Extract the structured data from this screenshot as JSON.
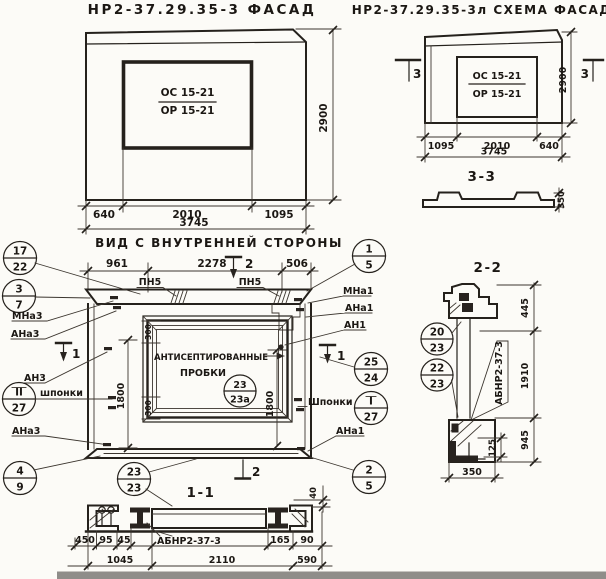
{
  "facade": {
    "title": "НР2-37.29.35-3 ФАСАД",
    "window_mark": {
      "top": "ОС 15-21",
      "bottom": "ОР 15-21"
    },
    "dims": {
      "left": "640",
      "mid": "2010",
      "right": "1095",
      "total": "3745",
      "height": "2900"
    }
  },
  "scheme": {
    "title": "НР2-37.29.35-3л СХЕМА ФАСАДА",
    "window_mark": {
      "top": "ОС 15-21",
      "bottom": "ОР 15-21"
    },
    "marker_left": "3",
    "marker_right": "3",
    "section_label": "3-3",
    "dims": {
      "left": "1095",
      "mid": "2010",
      "right": "640",
      "total": "3745",
      "height": "2900",
      "profile_thickness": "350"
    }
  },
  "inner_view": {
    "title": "ВИД С ВНУТРЕННЕЙ СТОРОНЫ",
    "dims": {
      "left": "961",
      "mid": "2278",
      "right": "506",
      "height_left": "1800",
      "height_right": "1800",
      "corner_top": "300",
      "corner_bottom": "300"
    },
    "markers": {
      "top": "2",
      "left": "1",
      "right": "1"
    },
    "labels": {
      "pn5_left": "ПН5",
      "pn5_right": "ПН5",
      "mna3": "МНа3",
      "ana3_top": "АНа3",
      "an3": "АН3",
      "shponki_left": "шпонки",
      "ana3_bottom": "АНа3",
      "mna1": "МНа1",
      "ana1_top": "АНа1",
      "an1": "АН1",
      "shponki_right": "Шпонки",
      "ana1_bottom": "АНа1",
      "plugs_line1": "АНТИСЕПТИРОВАННЫЕ",
      "plugs_line2": "ПРОБКИ"
    },
    "callouts": {
      "c17_22": {
        "top": "17",
        "bottom": "22"
      },
      "c3_7": {
        "top": "3",
        "bottom": "7"
      },
      "cII_27": {
        "top": "II",
        "bottom": "27"
      },
      "c4_9": {
        "top": "4",
        "bottom": "9"
      },
      "c23_23": {
        "top": "23",
        "bottom": "23"
      },
      "c1_5": {
        "top": "1",
        "bottom": "5"
      },
      "c25_24": {
        "top": "25",
        "bottom": "24"
      },
      "cI_27": {
        "top": "I",
        "bottom": "27"
      },
      "c2_5": {
        "top": "2",
        "bottom": "5"
      },
      "c23_23a": {
        "top": "23",
        "bottom": "23а"
      }
    }
  },
  "section_1_1": {
    "label": "1-1",
    "marker": "2",
    "part_label": "АБНР2-37-3",
    "dims": {
      "d450": "450",
      "d95": "95",
      "d45": "45",
      "d1045": "1045",
      "d2110": "2110",
      "d165": "165",
      "d90": "90",
      "d590": "590",
      "d40": "40"
    }
  },
  "section_2_2": {
    "label": "2-2",
    "part_label": "АБНР2-37-3",
    "dims": {
      "d445": "445",
      "d1910": "1910",
      "d945": "945",
      "d125": "125",
      "d350": "350"
    },
    "callouts": {
      "c20_23": {
        "top": "20",
        "bottom": "23"
      },
      "c22_23": {
        "top": "22",
        "bottom": "23"
      }
    }
  }
}
